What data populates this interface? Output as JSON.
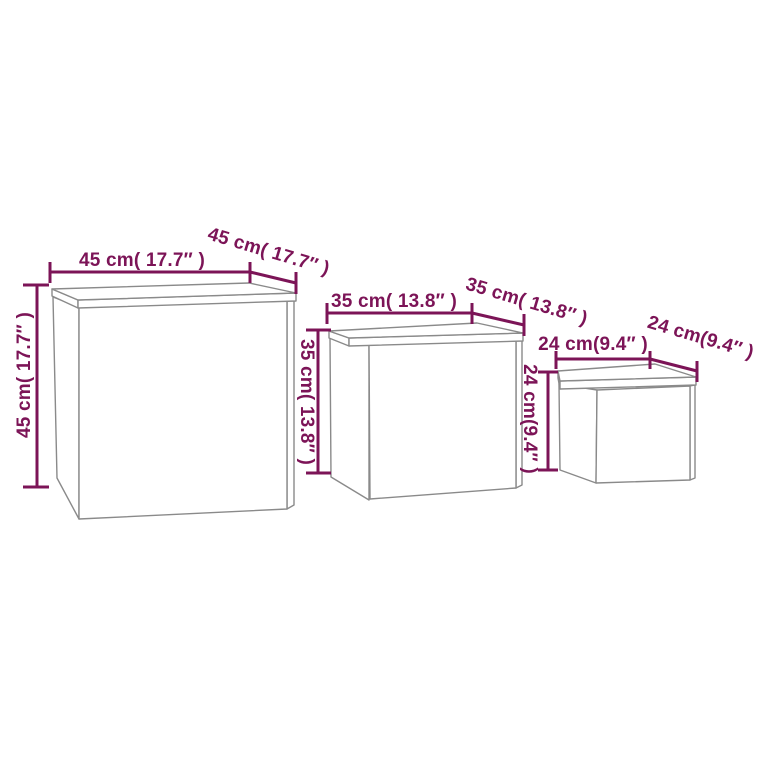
{
  "diagram": {
    "description": "Nesting tables dimension diagram, three tables of decreasing size",
    "unit_system": "cm with inches in parentheses"
  },
  "colors": {
    "dimension": "#7c1457",
    "outline": "#8a8a8a",
    "background": "#ffffff"
  },
  "tables": {
    "large": {
      "width_label": "45 cm( 17.7″ )",
      "depth_label": "45 cm( 17.7″ )",
      "height_label": "45 cm( 17.7″ )"
    },
    "medium": {
      "width_label": "35 cm( 13.8″ )",
      "depth_label": "35 cm( 13.8″ )",
      "height_label": "35 cm( 13.8″ )"
    },
    "small": {
      "width_label": "24 cm(9.4″ )",
      "depth_label": "24 cm(9.4″ )",
      "height_label": "24 cm(9.4″ )"
    }
  }
}
